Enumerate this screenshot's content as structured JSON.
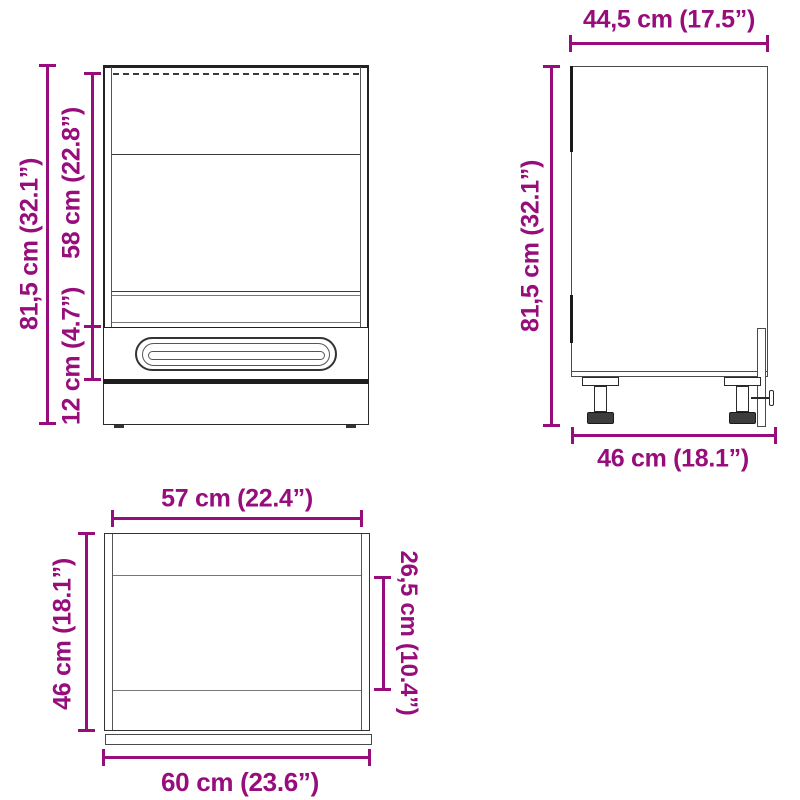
{
  "diagram": {
    "dimension_color": "#970d7c",
    "line_color_dark": "#222222",
    "line_color_gray": "#555555",
    "front_view": {
      "height_label": "81,5 cm (32.1”)",
      "opening_height_label": "58 cm (22.8”)",
      "drawer_height_label": "12 cm (4.7”)"
    },
    "side_view": {
      "width_label": "44,5 cm (17.5”)",
      "height_label": "81,5 cm (32.1”)",
      "depth_label": "46 cm (18.1”)"
    },
    "top_view": {
      "inner_width_label": "57 cm (22.4”)",
      "depth_label": "46 cm (18.1”)",
      "inner_depth_label": "26,5 cm (10.4”)",
      "width_label": "60 cm (23.6”)"
    }
  }
}
